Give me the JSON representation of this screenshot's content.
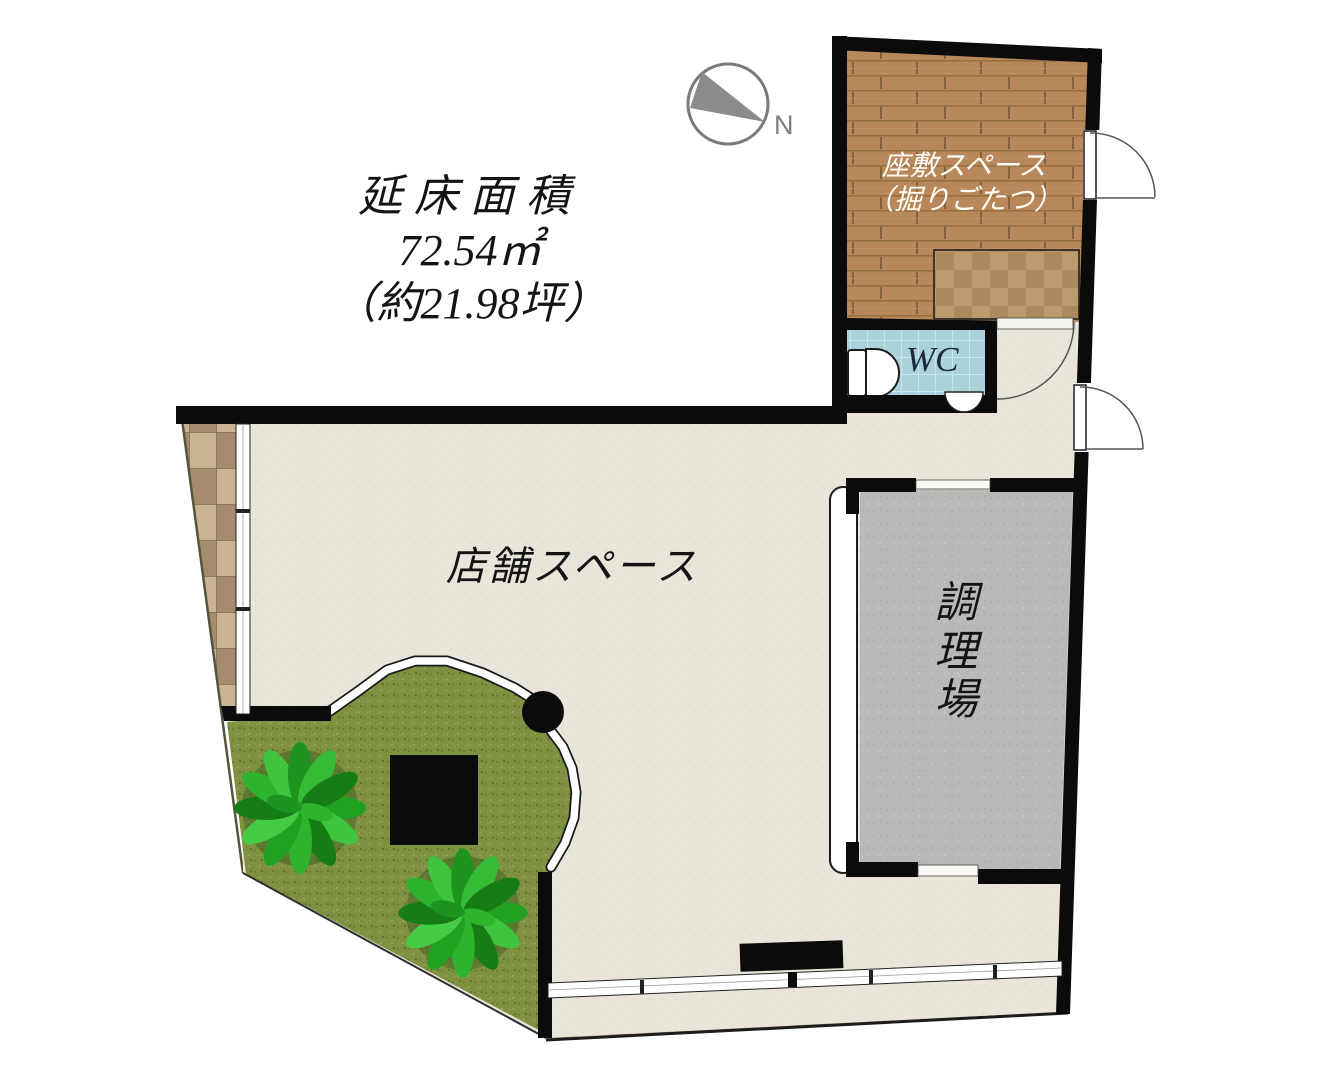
{
  "area_info": {
    "line1": "延床面積",
    "line2": "72.54㎡",
    "line3": "（約21.98坪）"
  },
  "compass": {
    "north_label": "N"
  },
  "rooms": {
    "zashiki": {
      "name": "座敷スペース",
      "note": "（掘りごたつ）"
    },
    "wc": {
      "name": "WC"
    },
    "kitchen": {
      "name": "調理場"
    },
    "shop": {
      "name": "店舗スペース"
    }
  },
  "colors": {
    "wall": "#0b0b0b",
    "floor_beige": "#e9e5da",
    "wood_floor": "#b8885a",
    "wood_seam": "#96703f",
    "kotatsu_light": "#bb9a6f",
    "kotatsu_dark": "#ac8a60",
    "wc_tile": "#a9d2da",
    "kitchen_gray": "#b9b9b7",
    "grass_green": "#7d9140",
    "bush_green": "#2fae2f",
    "tile_light": "#cbb493",
    "tile_dark": "#a58c6e",
    "label_dark": "#141414",
    "label_white": "#fffdf6",
    "wc_text": "#1c2740",
    "compass_gray": "#7d7d7d"
  }
}
